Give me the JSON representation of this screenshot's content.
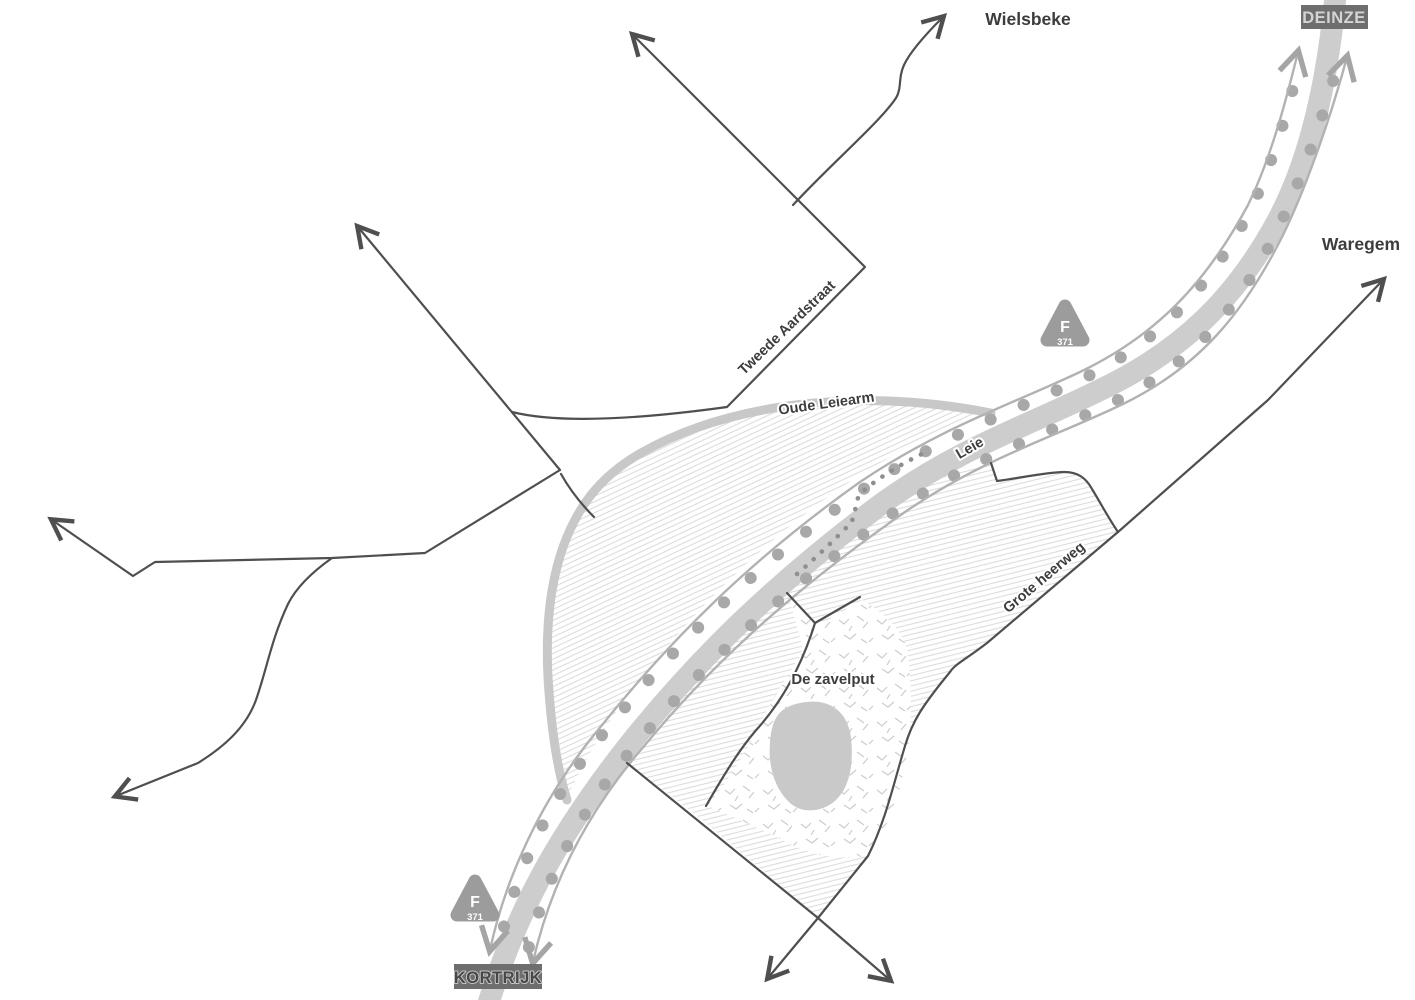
{
  "map": {
    "signs": {
      "deinze": "DEINZE",
      "kortrijk": "KORTRIJK"
    },
    "cities": {
      "wielsbeke": "Wielsbeke",
      "waregem": "Waregem"
    },
    "roads": {
      "tweede_aardstraat": "Tweede Aardstraat",
      "grote_heerweg": "Grote heerweg"
    },
    "water": {
      "leie": "Leie",
      "oude_leiearm": "Oude Leiearm"
    },
    "areas": {
      "de_zavelput": "De zavelput"
    },
    "route_badge": {
      "letter": "F",
      "number": "371"
    },
    "colors": {
      "road": "#4f4f4f",
      "river": "#cdcdcd",
      "old_arm": "#c8c8c8",
      "route_line": "#b2b2b2",
      "tree_dots": "#a8a8a8",
      "route_dots": "#8f8f8f",
      "hatch": "#dcdcdc",
      "scrub": "#cccccc",
      "pond": "#c9c9c9",
      "label_text": "#3d3d3d",
      "badge": "#9c9c9c",
      "sign_background": "#6e6e6e",
      "sign_text_light": "#d4d4d4",
      "sign_text_dark": "#474747"
    }
  }
}
